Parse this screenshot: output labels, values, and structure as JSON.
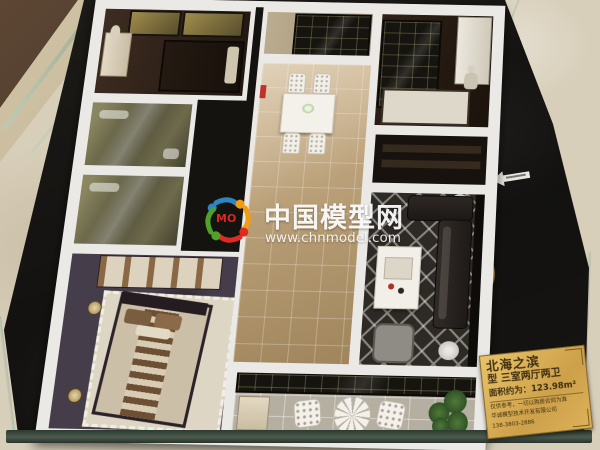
{
  "watermark": {
    "site_name": "中国模型网",
    "site_url": "www.chnmodel.com",
    "logo_text": "MO",
    "logo_colors": {
      "blue": "#2e86c1",
      "orange": "#f39c12",
      "red": "#e02a20",
      "green": "#4fa12a"
    }
  },
  "plaque": {
    "project_name": "北海之滨",
    "unit_line": "型 三室两厅两卫",
    "area_line": "面积约为：123.98m²",
    "disclaimer": "仅供参考，一切以购房合同为准",
    "company": "华诚模型技术开发有限公司",
    "phone": "138-3803-2886",
    "gold_color": "#d9b25e"
  },
  "scene": {
    "base_color": "#15130f",
    "marble_color": "#d8cfba",
    "glass_edge_color": "#9db3a0",
    "wall_color": "#eae9e5"
  }
}
